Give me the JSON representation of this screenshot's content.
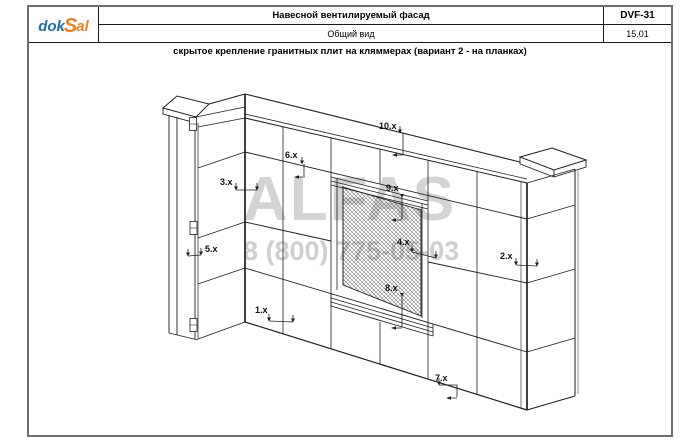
{
  "header": {
    "logo": {
      "prefix": "dok",
      "accent": "S",
      "suffix": "al"
    },
    "title": "Навесной вентилируемый фасад",
    "doc_code": "DVF-31",
    "view_label": "Общий вид",
    "sheet_number": "15.01"
  },
  "drawing": {
    "subtitle": "скрытое крепление гранитных плит на кляммерах (вариант 2 - на планках)",
    "callouts": [
      {
        "label": "1.x"
      },
      {
        "label": "2.x"
      },
      {
        "label": "3.x"
      },
      {
        "label": "4.x"
      },
      {
        "label": "5.x"
      },
      {
        "label": "6.x"
      },
      {
        "label": "7.x"
      },
      {
        "label": "8.x"
      },
      {
        "label": "9.x"
      },
      {
        "label": "10.x"
      }
    ]
  },
  "watermark": {
    "name": "ALFAS",
    "phone": "8 (800) 775-05-03"
  },
  "colors": {
    "logo_blue": "#1e6db2",
    "logo_orange": "#f07f1f",
    "line": "#1f1f1f",
    "watermark_name": "#d4d4d4",
    "watermark_phone": "#cfcfcf"
  }
}
